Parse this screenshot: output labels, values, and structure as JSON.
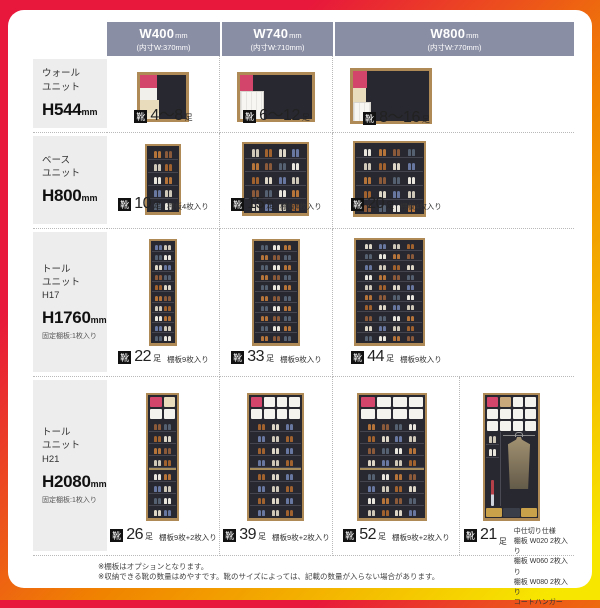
{
  "colors": {
    "bg_red": "#e8173c",
    "bg_orange": "#f08300",
    "bg_yellow": "#f7e600",
    "header_bg": "#8a8ea4",
    "header_text": "#ffffff",
    "row_label_bg": "#ededed",
    "dotted_line": "#b9b9b9",
    "cabinet_frame": "#b08a56",
    "cabinet_interior": "#282830",
    "box_pink": "#d4456b",
    "box_cream": "#e9dcbd",
    "box_white": "#f5f3ee",
    "box_tan": "#c9a87c",
    "shoe_palette": [
      "#ddd6c6",
      "#b5743a",
      "#67779f",
      "#8a5a3a",
      "#cfc8b8",
      "#556070",
      "#a0622e",
      "#e8e5dd"
    ]
  },
  "badge_icon": "靴",
  "columns": [
    {
      "size": "W400",
      "unit": "mm",
      "inner": "(内寸W:370mm)"
    },
    {
      "size": "W740",
      "unit": "mm",
      "inner": "(内寸W:710mm)"
    },
    {
      "size": "W800",
      "unit": "mm",
      "inner": "(内寸W:770mm)"
    }
  ],
  "rows": [
    {
      "lines": [
        "ウォール",
        "ユニット"
      ],
      "h": "H544",
      "hu": "mm",
      "note": ""
    },
    {
      "lines": [
        "ベース",
        "ユニット"
      ],
      "h": "H800",
      "hu": "mm",
      "note": ""
    },
    {
      "lines": [
        "トール",
        "ユニット",
        "H17"
      ],
      "h": "H1760",
      "hu": "mm",
      "note": "固定棚板:1枚入り"
    },
    {
      "lines": [
        "トール",
        "ユニット",
        "H21"
      ],
      "h": "H2080",
      "hu": "mm",
      "note": "固定棚板:1枚入り"
    }
  ],
  "cells": [
    {
      "row": 0,
      "col": 0,
      "capacity": "4〜8",
      "unit": "足",
      "note": "",
      "cabinet": {
        "kind": "wall-boxes"
      }
    },
    {
      "row": 0,
      "col": 1,
      "capacity": "6〜12",
      "unit": "足",
      "note": "",
      "cabinet": {
        "kind": "wall-doors"
      }
    },
    {
      "row": 0,
      "col": 2,
      "capacity": "8〜16",
      "unit": "足",
      "note": "",
      "cabinet": {
        "kind": "wall-stepped"
      }
    },
    {
      "row": 1,
      "col": 0,
      "capacity": "10",
      "unit": "足",
      "note": "棚板4枚入り",
      "cabinet": {
        "kind": "shoes",
        "rows": 5,
        "cols": 2
      }
    },
    {
      "row": 1,
      "col": 1,
      "capacity": "15",
      "unit": "足",
      "note": "棚板4枚入り",
      "cabinet": {
        "kind": "shoes",
        "rows": 5,
        "cols": 4
      }
    },
    {
      "row": 1,
      "col": 2,
      "capacity": "20",
      "unit": "足",
      "note": "棚板4枚入り",
      "cabinet": {
        "kind": "shoes",
        "rows": 5,
        "cols": 4
      }
    },
    {
      "row": 2,
      "col": 0,
      "capacity": "22",
      "unit": "足",
      "note": "棚板9枚入り",
      "cabinet": {
        "kind": "shoes",
        "rows": 10,
        "cols": 2
      }
    },
    {
      "row": 2,
      "col": 1,
      "capacity": "33",
      "unit": "足",
      "note": "棚板9枚入り",
      "cabinet": {
        "kind": "shoes",
        "rows": 10,
        "cols": 3
      }
    },
    {
      "row": 2,
      "col": 2,
      "capacity": "44",
      "unit": "足",
      "note": "棚板9枚入り",
      "cabinet": {
        "kind": "shoes",
        "rows": 10,
        "cols": 4
      }
    },
    {
      "row": 3,
      "col": 0,
      "capacity": "26",
      "unit": "足",
      "note": "棚板9枚+2枚入り",
      "cabinet": {
        "kind": "tall-mixed",
        "rows": 8,
        "cols": 2,
        "boxCols": 2
      }
    },
    {
      "row": 3,
      "col": 1,
      "capacity": "39",
      "unit": "足",
      "note": "棚板9枚+2枚入り",
      "cabinet": {
        "kind": "tall-mixed",
        "rows": 8,
        "cols": 3,
        "boxCols": 4
      }
    },
    {
      "row": 3,
      "col": 2,
      "capacity": "52",
      "unit": "足",
      "note": "棚板9枚+2枚入り",
      "cabinet": {
        "kind": "tall-mixed",
        "rows": 8,
        "cols": 4,
        "boxCols": 4
      }
    },
    {
      "row": 3,
      "col": 3,
      "capacity": "21",
      "unit": "足",
      "note_lines": [
        "中仕切り仕様",
        "棚板 W020 2枚入り",
        "棚板 W060 2枚入り",
        "棚板 W080 2枚入り",
        "コートハンガー"
      ],
      "cabinet": {
        "kind": "coat"
      }
    }
  ],
  "footnotes": [
    "※棚板はオプションとなります。",
    "※収納できる靴の数量はめやすです。靴のサイズによっては、記載の数量が入らない場合があります。"
  ]
}
